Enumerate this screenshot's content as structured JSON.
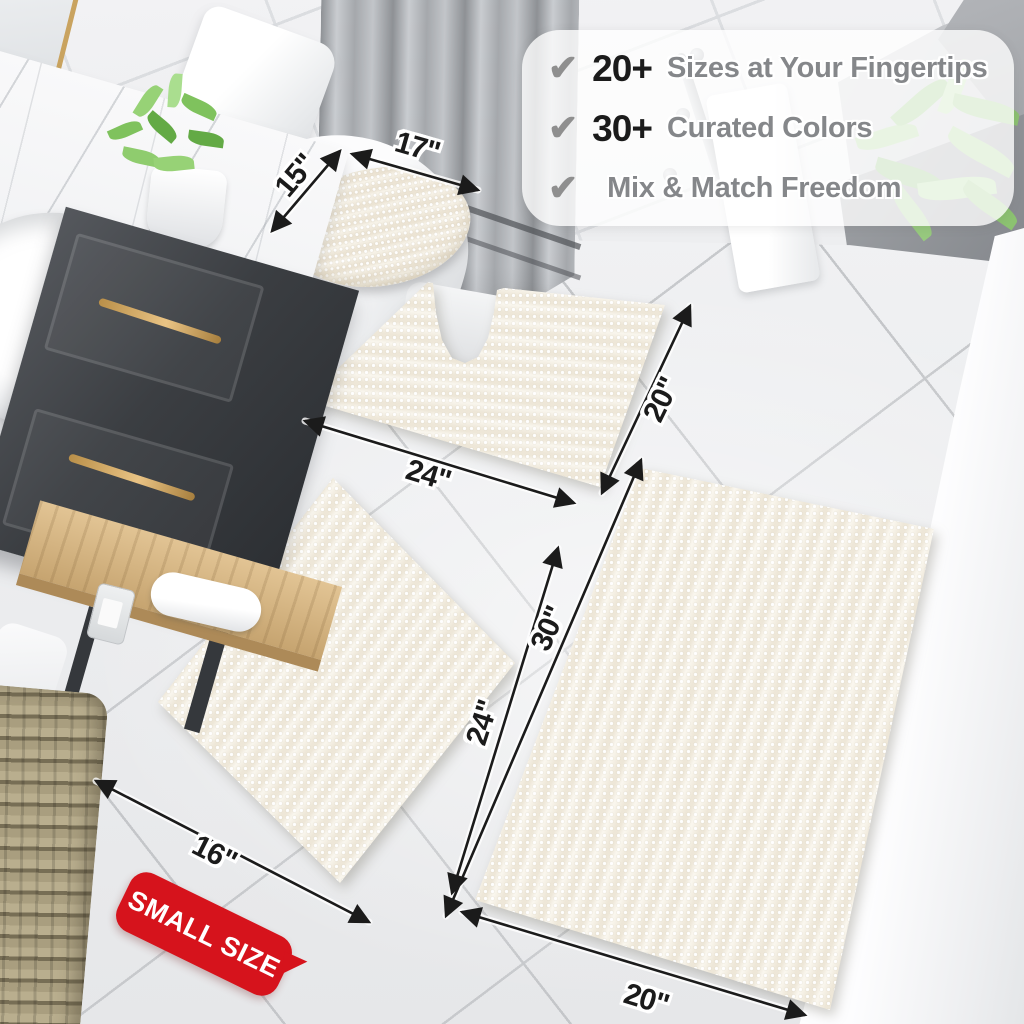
{
  "callout": {
    "items": [
      {
        "icon": "checkmark",
        "number": "20+",
        "text": "Sizes at Your Fingertips"
      },
      {
        "icon": "checkmark",
        "number": "30+",
        "text": "Curated Colors"
      },
      {
        "icon": "checkmark",
        "number": "",
        "text": "Mix & Match Freedom"
      }
    ]
  },
  "dims": {
    "lid_width": "17\"",
    "lid_depth": "15\"",
    "contour_width": "24\"",
    "contour_depth": "20\"",
    "small_width": "16\"",
    "small_length": "24\"",
    "large_length": "30\"",
    "large_width": "20\""
  },
  "badge": {
    "label": "SMALL SIZE"
  },
  "colors": {
    "badge_red": "#d6131c",
    "dimension_ink": "#1b1b1b",
    "callout_number": "#1b1b1b",
    "callout_text": "#85878a",
    "checkmark_gray": "#8f8f8f",
    "rug_ivory": "#f6f3ea",
    "cabinet_charcoal": "#3b3e42",
    "brass_handle": "#c9a35f"
  }
}
